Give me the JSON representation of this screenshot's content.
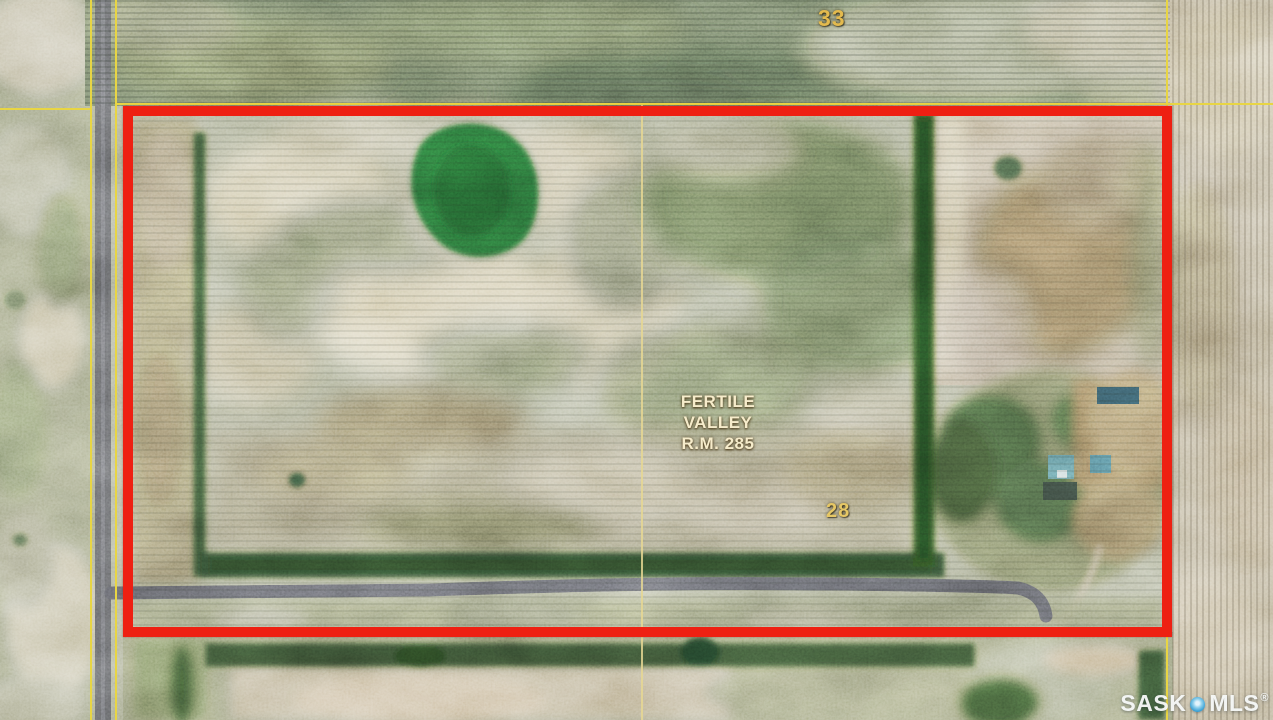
{
  "theme": {
    "boundary-red": "#ee2012",
    "grid-yellow": "#e8d544",
    "grid-yellow-pale": "#e6d793",
    "label-gold": "#e3ba4e",
    "rm-cream": "#f6eccb",
    "road-gray": "#55565a",
    "watermark-blue": "#2394cf"
  },
  "map": {
    "section_labels": [
      {
        "text": "33"
      },
      {
        "text": "28"
      }
    ],
    "municipality": {
      "line1": "FERTILE",
      "line2": "VALLEY",
      "line3": "R.M. 285"
    },
    "watermark": {
      "prefix": "SASK",
      "suffix": "MLS",
      "registered": "®",
      "dot_icon": "location-dot"
    }
  }
}
